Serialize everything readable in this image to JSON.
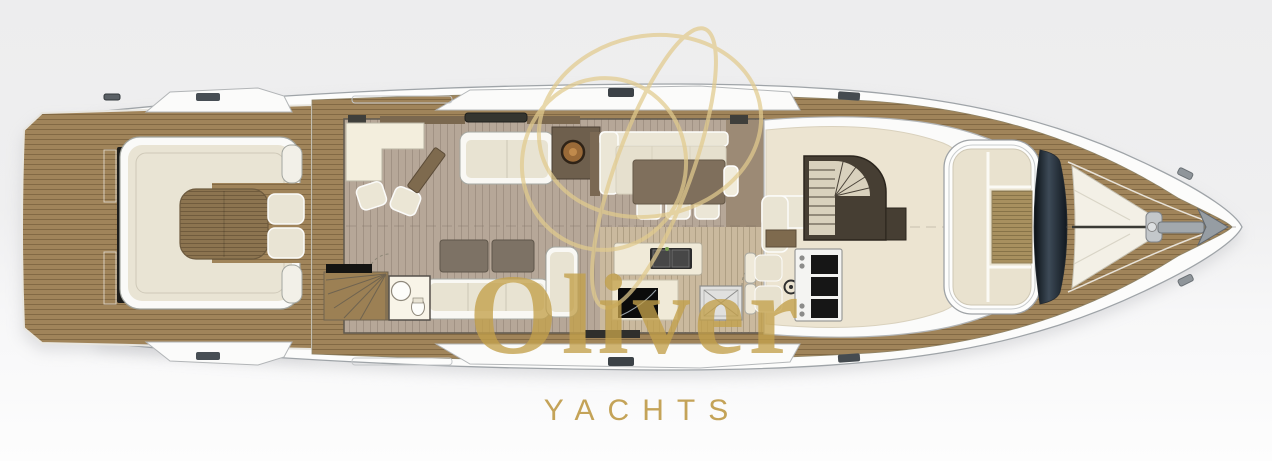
{
  "watermark": {
    "brand": "Oliver",
    "tagline": "YACHTS",
    "gold_color": "#c6a34a"
  },
  "palette": {
    "background_top": "#ededee",
    "background_bottom": "#fdfdfd",
    "hull_white": "#fcfcfb",
    "outline_gray": "#9fa4a8",
    "teak_deck": "#a0845a",
    "salon_floor": "#b6a798",
    "galley_floor": "#cab99e",
    "helm_floor": "#ece4d1",
    "upholstery_cream": "#e9e4d3",
    "trim_white": "#fafaf8",
    "wood_table": "#8c7450",
    "glass_dark": "#141c24",
    "stair_dark": "#463e33"
  },
  "plan": {
    "type": "yacht-main-deck-floor-plan",
    "orientation": "bow-right",
    "areas": [
      "swim-platform",
      "aft-deck-lounge",
      "salon",
      "dining",
      "day-head",
      "galley",
      "helm-station",
      "companionway-stairs",
      "bow-lounge",
      "windshield",
      "foredeck-sunpads",
      "anchor-windlass"
    ]
  }
}
